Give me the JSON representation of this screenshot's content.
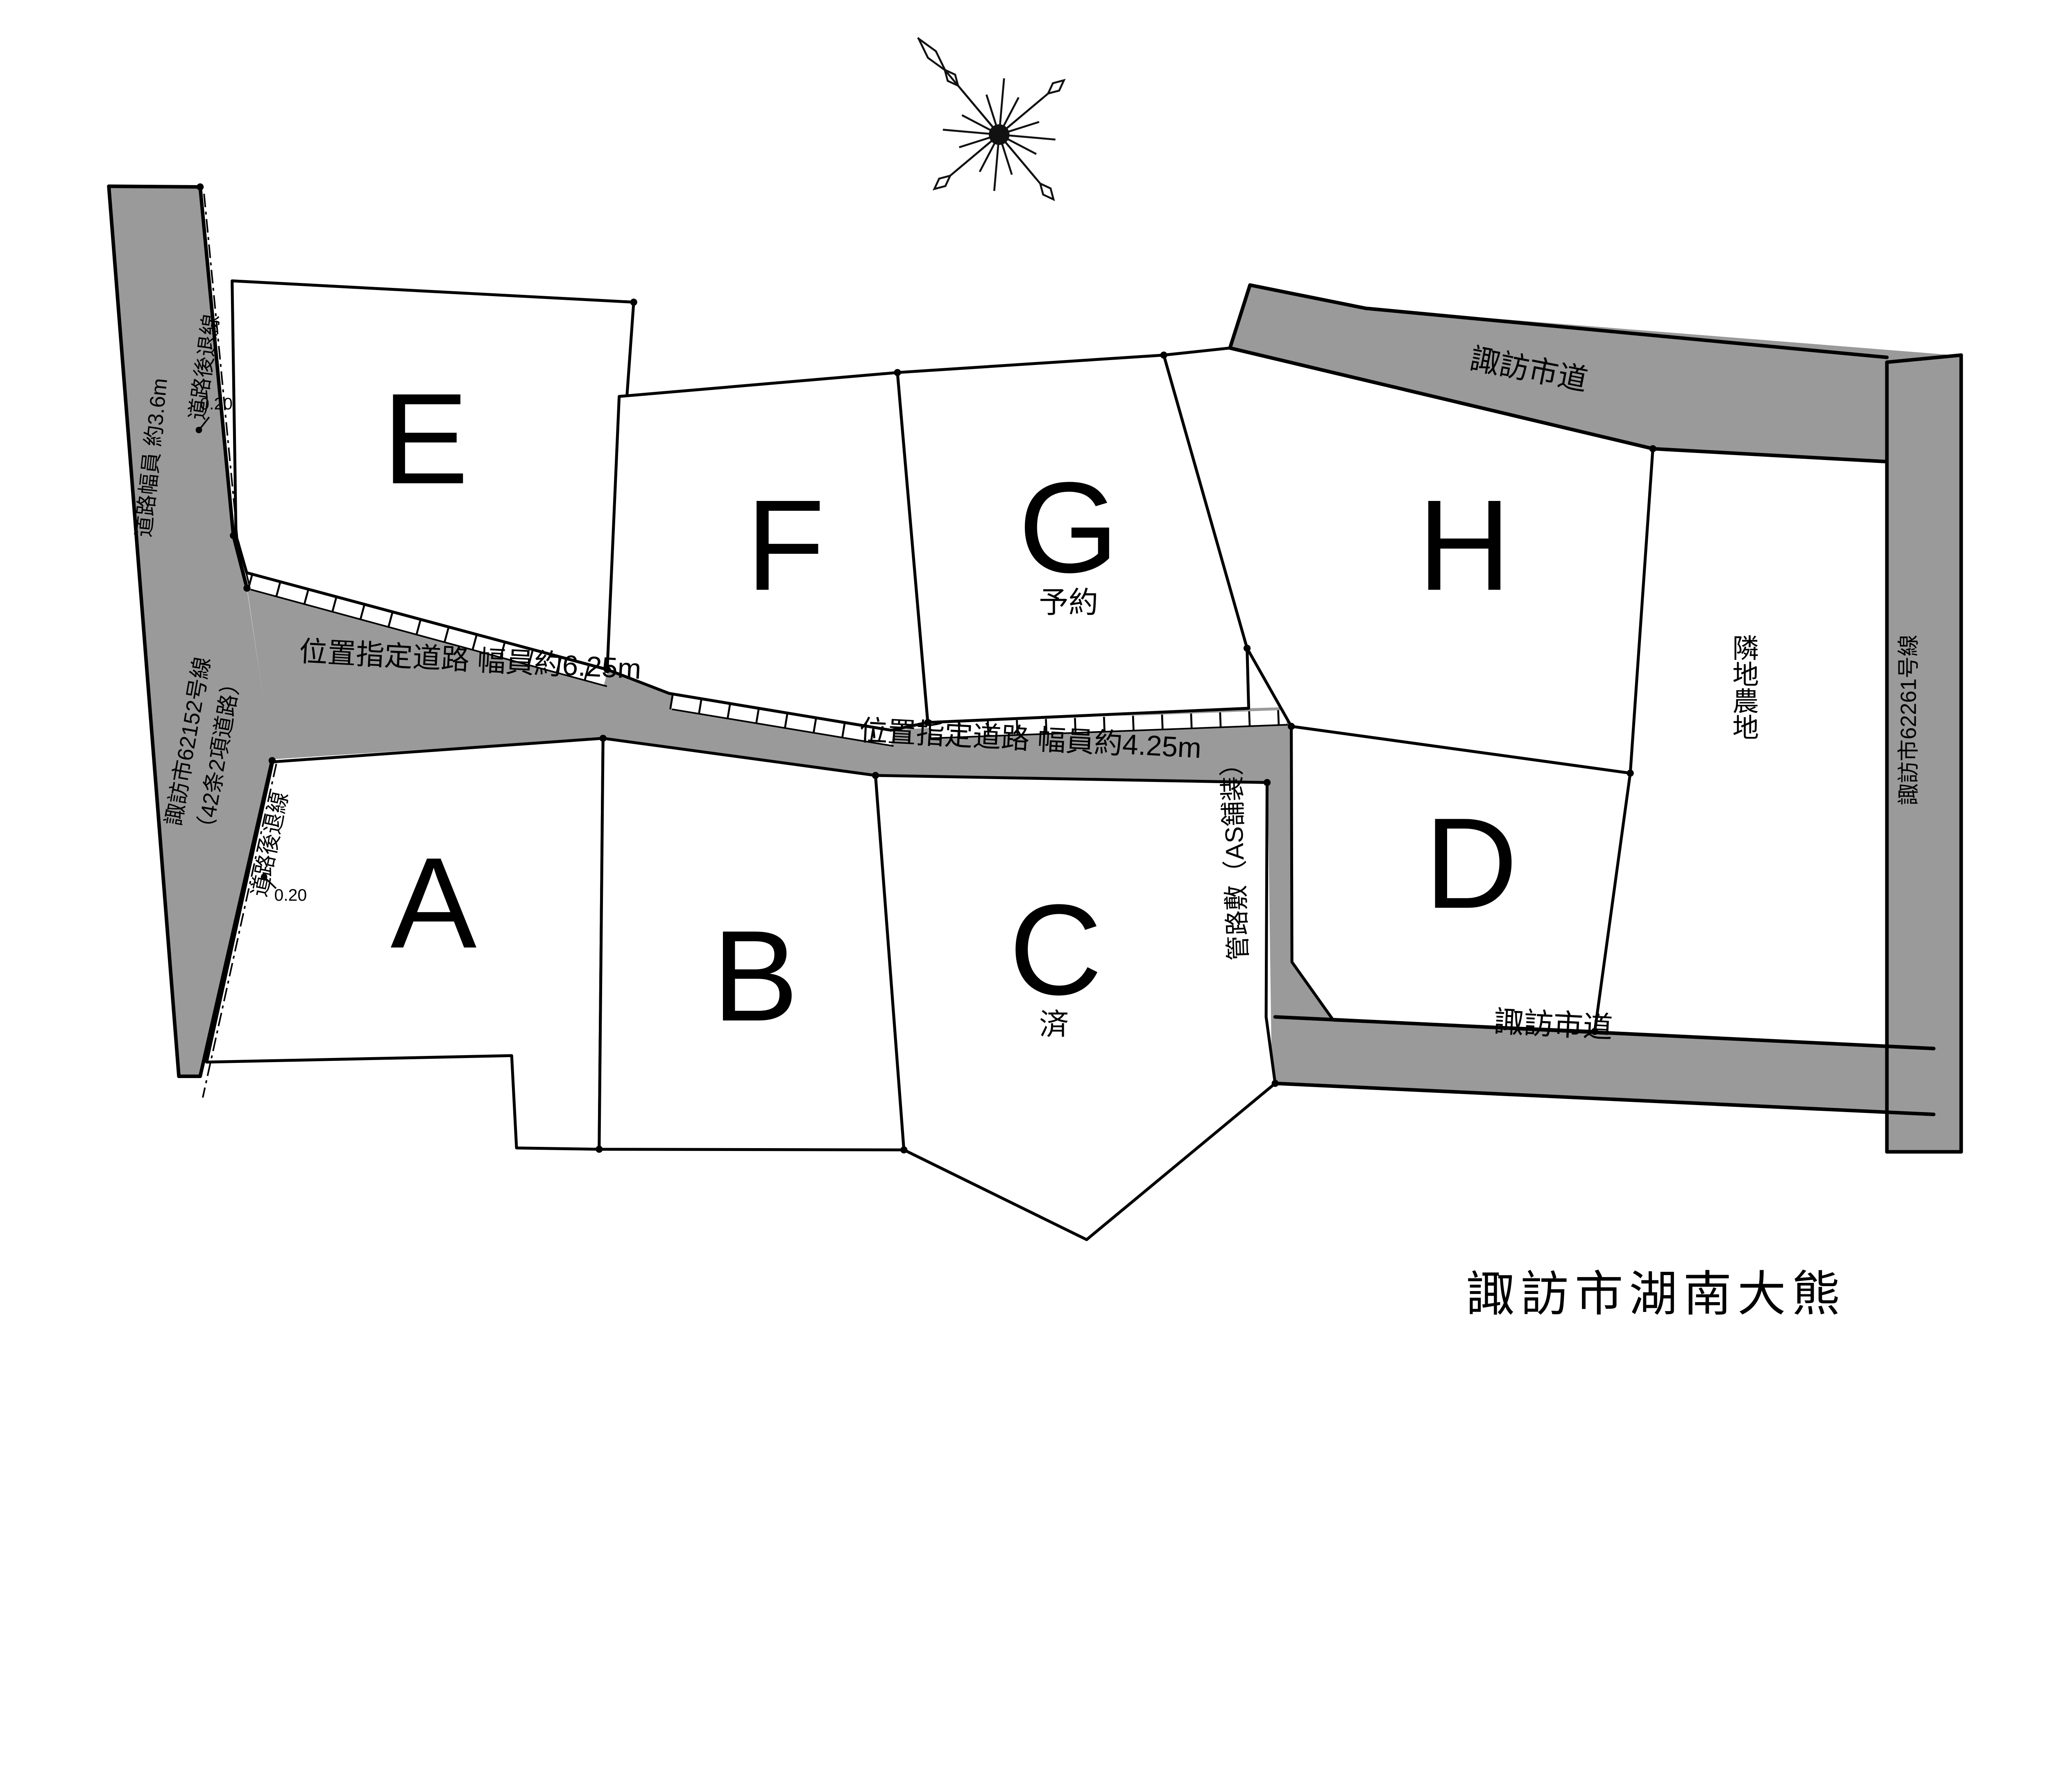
{
  "district_label": "諏訪市湖南大熊",
  "colors": {
    "road_fill": "#9a9a9a",
    "plot_available": "#d8352b",
    "plot_reserved": "#a7c1dd",
    "plot_sold": "#c9c9c9",
    "district_text": "#c8c8c8"
  },
  "roads": {
    "left_width_label": "道路幅員 約3.6m",
    "left_name_line1": "諏訪市62152号線",
    "left_name_line2": "（42条2項道路）",
    "setback_upper_label": "道路後退線",
    "setback_upper_dim": "0.20",
    "setback_lower_label": "道路後退線",
    "setback_lower_dim": "0.20",
    "designated_625": "位置指定道路 幅員約6.25m",
    "designated_425": "位置指定道路 幅員約4.25m",
    "pipe_label": "管路敷（AS舗装）",
    "city_road_top": "諏訪市道",
    "city_road_bottom": "諏訪市道",
    "right_name": "諏訪市62261号線",
    "adjacent_farmland": "隣地農地"
  },
  "plots": [
    {
      "id": "A",
      "status": "",
      "color": "#d8352b"
    },
    {
      "id": "B",
      "status": "",
      "color": "#d8352b"
    },
    {
      "id": "C",
      "status": "済",
      "color": "#c9c9c9"
    },
    {
      "id": "D",
      "status": "",
      "color": "#d8352b"
    },
    {
      "id": "E",
      "status": "",
      "color": "#d8352b"
    },
    {
      "id": "F",
      "status": "",
      "color": "#d8352b"
    },
    {
      "id": "G",
      "status": "予約",
      "color": "#a7c1dd"
    },
    {
      "id": "H",
      "status": "",
      "color": "#d8352b"
    }
  ]
}
